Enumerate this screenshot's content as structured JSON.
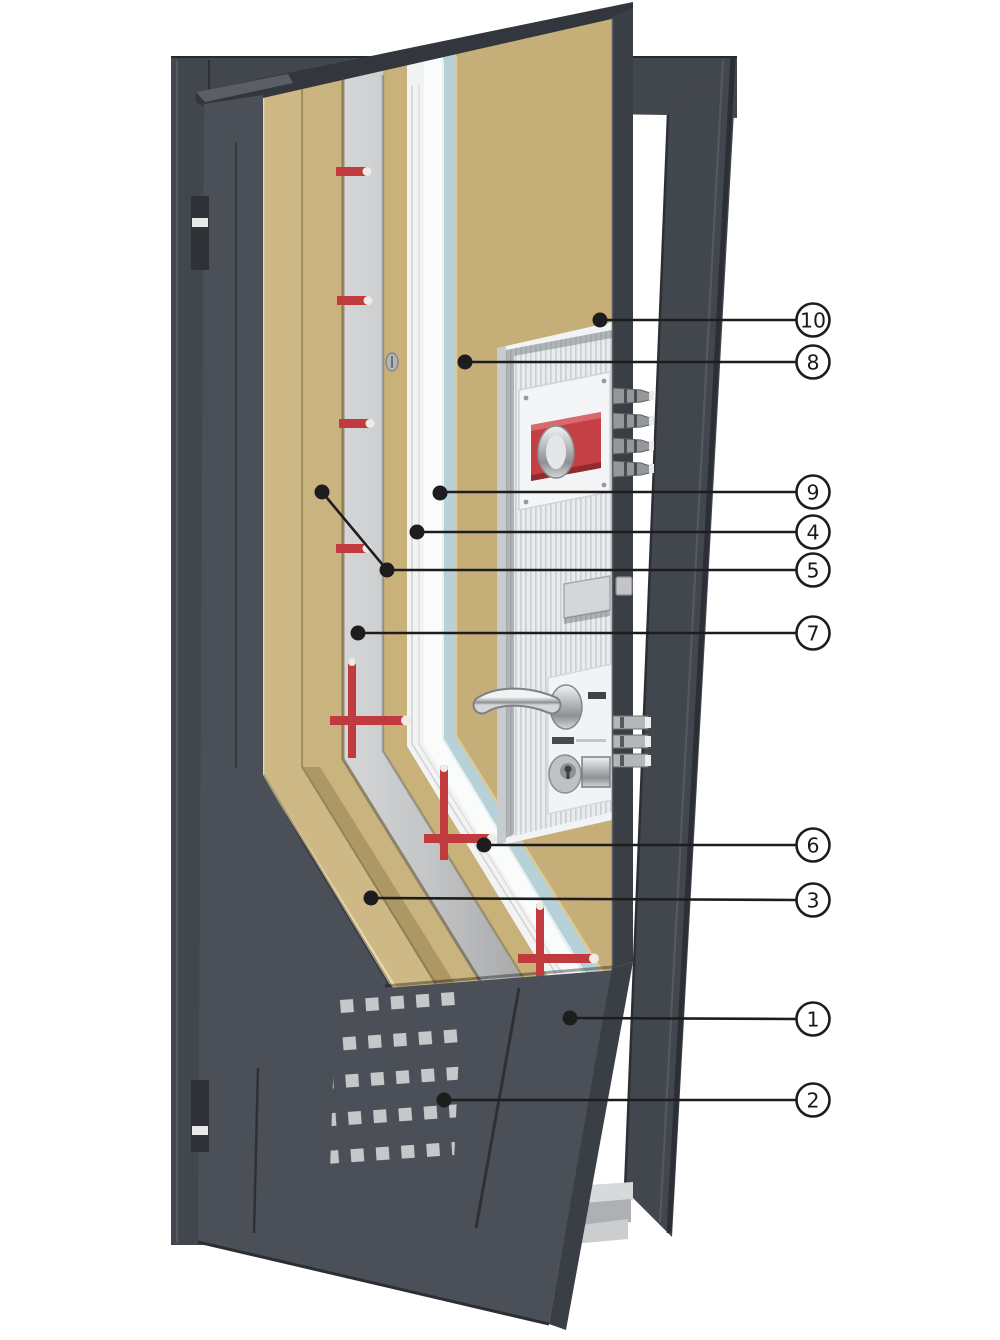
{
  "callouts": [
    {
      "label": "10"
    },
    {
      "label": "8"
    },
    {
      "label": "9"
    },
    {
      "label": "4"
    },
    {
      "label": "5"
    },
    {
      "label": "7"
    },
    {
      "label": "6"
    },
    {
      "label": "3"
    },
    {
      "label": "1"
    },
    {
      "label": "2"
    }
  ],
  "colors": {
    "background": "#ffffff",
    "frame": "#42464d",
    "frame_shadow": "#2c2f35",
    "door_face": "#4b5058",
    "door_edge": "#3a3e45",
    "door_cap": "#33373d",
    "chipboard_tan": "#c9b37e",
    "chipboard_tan_dark": "#b49d68",
    "mdf_panel": "#c5ae78",
    "steel_channel": "#c0c2c4",
    "sheet_white": "#f2f3f3",
    "insulation_blue": "#b7d1d8",
    "fastener_red": "#c13a3e",
    "chrome": "#c6c8ca",
    "pocket_white": "#e9ebed",
    "sill_gray": "#c4c6c8",
    "callout_line": "#1d1d1d",
    "callout_fill": "#ffffff"
  }
}
